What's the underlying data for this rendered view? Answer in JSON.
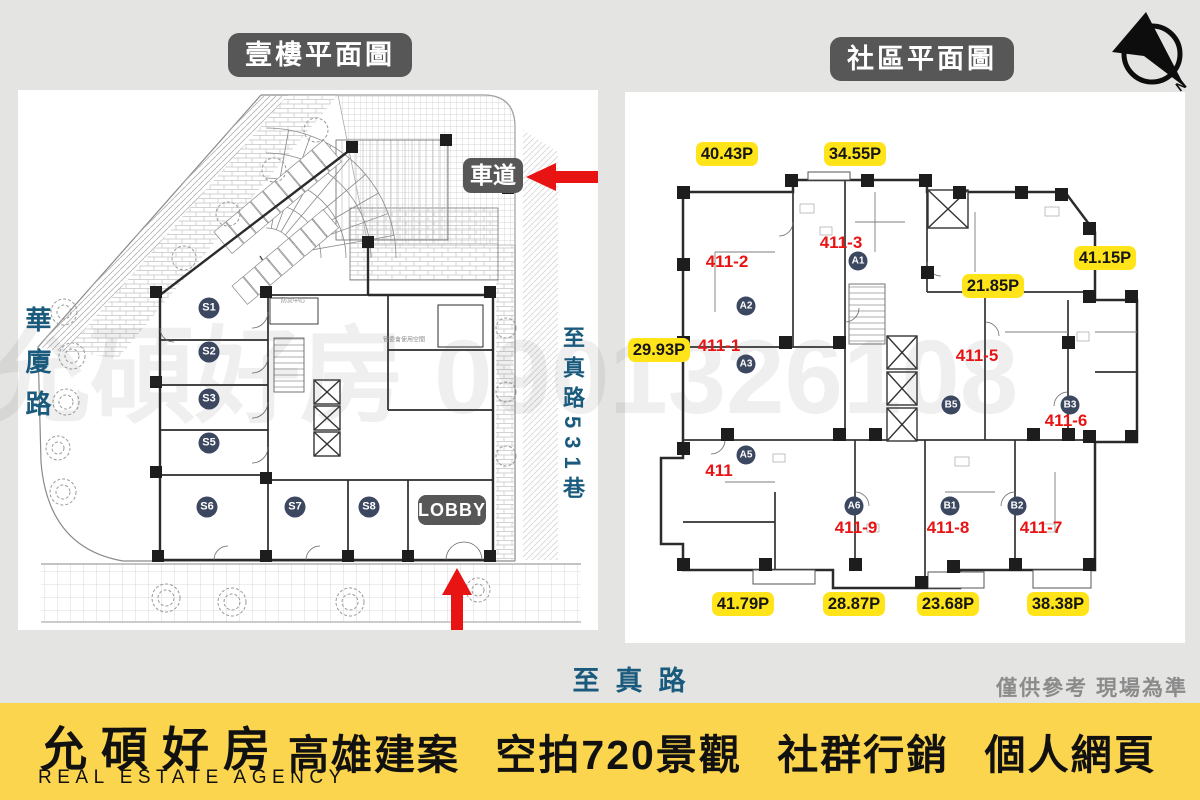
{
  "header": {
    "left_title": "壹樓平面圖",
    "right_title": "社區平面圖",
    "compass_letter": "N"
  },
  "left_plan": {
    "driveway_label": "車道",
    "lobby_label": "LOBBY",
    "stalls": [
      "S1",
      "S2",
      "S3",
      "S5",
      "S6",
      "S7",
      "S8"
    ],
    "room_labels": [
      "防災中心",
      "管委會使用空間"
    ],
    "roads": {
      "left_vertical": "華廈路",
      "right_vertical": "至真路531巷",
      "bottom": "至真路"
    }
  },
  "right_plan": {
    "area_badges": [
      "40.43P",
      "34.55P",
      "41.15P",
      "21.85P",
      "29.93P",
      "41.79P",
      "28.87P",
      "23.68P",
      "38.38P"
    ],
    "unit_numbers": [
      "411-2",
      "411-3",
      "411-1",
      "411-5",
      "411-6",
      "411",
      "411-9",
      "411-8",
      "411-7"
    ],
    "type_circles": [
      "A1",
      "A2",
      "A3",
      "A5",
      "A6",
      "B1",
      "B2",
      "B3",
      "B5"
    ]
  },
  "watermark": "允碩好房 0901326108",
  "disclaimer": "僅供參考 現場為準",
  "footer": {
    "brand": "允碩好房",
    "brand_sub": "REAL ESTATE AGENCY",
    "tagline": "高雄建案 空拍720景觀 社群行銷 個人網頁"
  },
  "colors": {
    "accent_red": "#e81414",
    "badge_yellow": "#ffe41a",
    "label_gray": "#575757",
    "road_teal": "#1a5a7d",
    "circle_navy": "#3c4760",
    "footer_yellow": "#fbd54d"
  }
}
